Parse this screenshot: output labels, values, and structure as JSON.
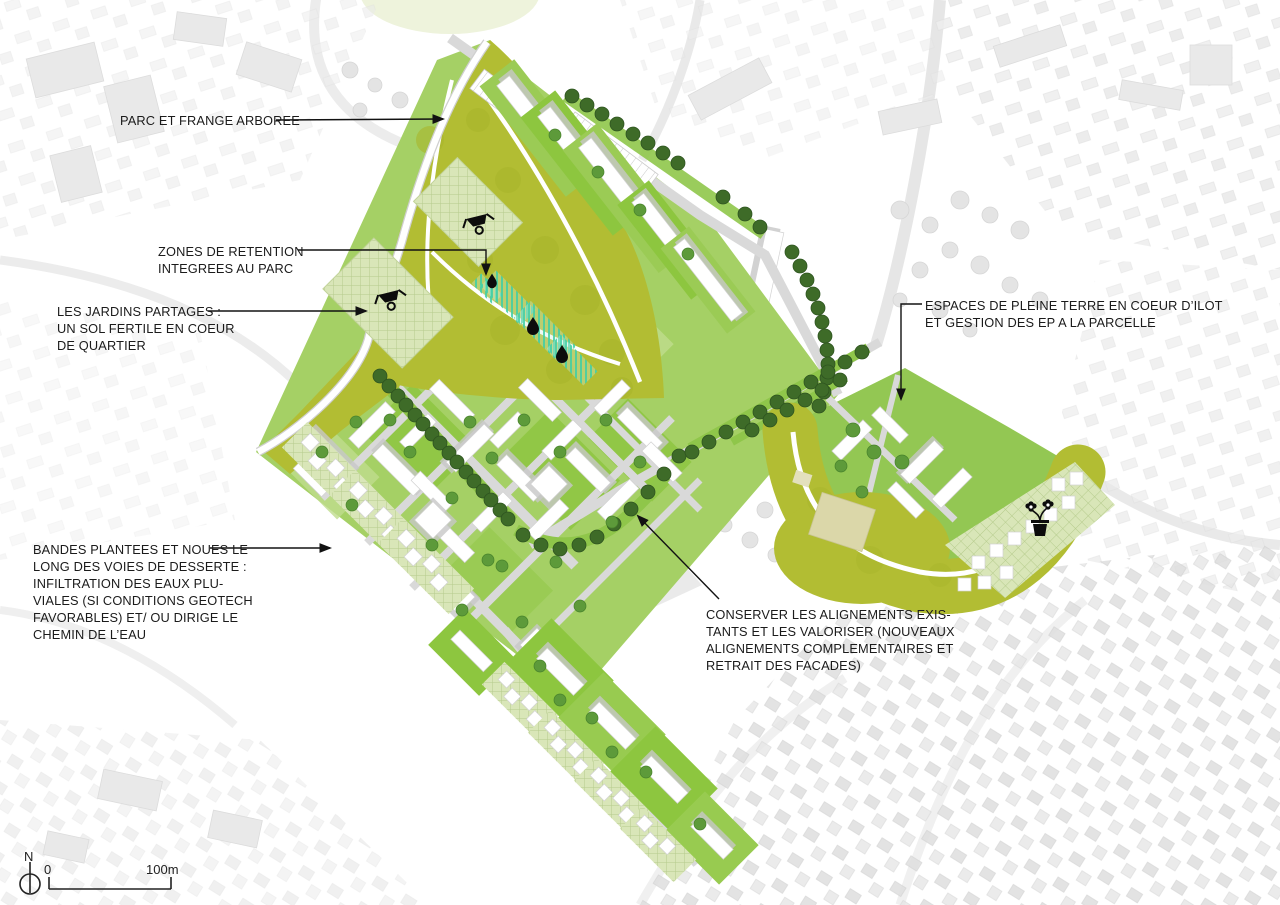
{
  "annotations": [
    {
      "id": "parc",
      "text": "PARC ET FRANGE ARBOREE"
    },
    {
      "id": "retention",
      "text": "ZONES DE RETENTION\nINTEGREES AU PARC"
    },
    {
      "id": "jardins",
      "text": "LES JARDINS PARTAGES :\nUN SOL FERTILE EN COEUR\nDE QUARTIER"
    },
    {
      "id": "bandes",
      "text": "BANDES PLANTEES ET NOUES LE\nLONG DES VOIES DE DESSERTE :\nINFILTRATION DES EAUX PLU-\nVIALES (SI CONDITIONS GEOTECH\nFAVORABLES) ET/ OU DIRIGE LE\nCHEMIN DE L’EAU"
    },
    {
      "id": "pleine_terre",
      "text": "ESPACES DE PLEINE TERRE EN COEUR D’ILOT\nET GESTION DES EP A LA PARCELLE"
    },
    {
      "id": "alignements",
      "text": "CONSERVER LES ALIGNEMENTS EXIS-\nTANTS ET LES VALORISER (NOUVEAUX\nALIGNEMENTS COMPLEMENTAIRES ET\nRETRAIT DES FACADES)"
    }
  ],
  "scale_bar": {
    "north_label": "N",
    "start_label": "0",
    "end_label": "100m"
  },
  "icons": [
    "wheelbarrow-icon (park)",
    "wheelbarrow-icon (jardins partages)",
    "water-drop-icon x3 (zones de retention)",
    "potted-plant-icon (coeur d ilot)",
    "north-arrow",
    "scale-bar"
  ],
  "colors": {
    "park_olive": "#b2bd33",
    "parcel_green": "#8dc63f",
    "parcel_light_green": "#c0dd8d",
    "hatch_pale_green": "#d9e6b8",
    "tree_dark_green": "#3e6b28",
    "tree_mid_green": "#5d9a3a",
    "retention_teal": "#3fcfa5",
    "road_grey": "#d9d9d9",
    "building_white": "#ffffff",
    "shadow_grey": "#c7c7c7",
    "equipment_beige": "#dbd7a9",
    "annotation_text": "#1b1b1b"
  }
}
